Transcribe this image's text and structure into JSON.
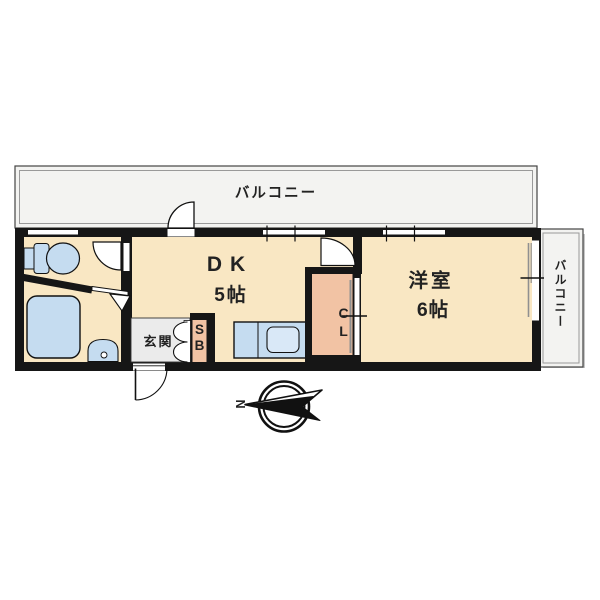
{
  "plan": {
    "type": "apartment-floor-plan",
    "balcony_top": {
      "label": "バルコニー"
    },
    "balcony_right": {
      "label": "バルコニー"
    },
    "dining_kitchen": {
      "name": "DK",
      "size": "5帖"
    },
    "western_room": {
      "name": "洋室",
      "size": "6帖"
    },
    "entrance": {
      "label": "玄関"
    },
    "shoe_box": {
      "letter1": "S",
      "letter2": "B"
    },
    "closet": {
      "letter1": "C",
      "letter2": "L"
    },
    "compass": {
      "north_label": "N"
    }
  },
  "colors": {
    "wall": "#161616",
    "floor": "#F9E7C3",
    "closet_fill": "#F2C3A4",
    "fixture_blue": "#C5DCF0",
    "sink_blue": "#D9E8F7",
    "entrance_gray": "#EBEBEB",
    "balcony_gray": "#F3F3F1",
    "balcony_shadow": "#C6C6C6",
    "line_gray": "#909090",
    "text": "#222222"
  }
}
